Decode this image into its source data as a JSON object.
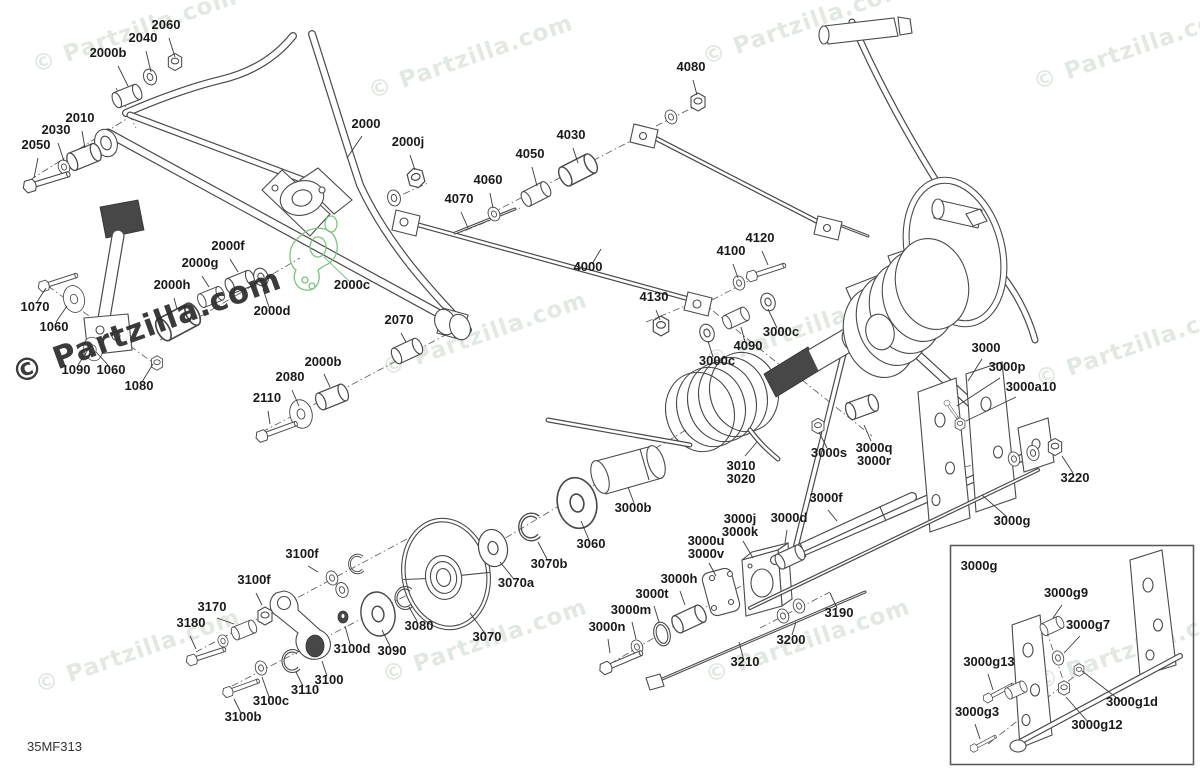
{
  "diagram": {
    "code": "35MF313",
    "watermark": {
      "text": "© Partzilla.com",
      "light_color": "#e2e8e2",
      "dark_color": "#2b2b2b"
    },
    "colors": {
      "line": "#4a4a4a",
      "label_text": "#1a1a1a",
      "highlight_green": "#7bc47f"
    },
    "watermarks": [
      {
        "x": 137,
        "y": 38,
        "rot": -19,
        "variant": "light"
      },
      {
        "x": 473,
        "y": 64,
        "rot": -19,
        "variant": "light"
      },
      {
        "x": 807,
        "y": 30,
        "rot": -19,
        "variant": "light"
      },
      {
        "x": 1138,
        "y": 55,
        "rot": -19,
        "variant": "light"
      },
      {
        "x": 150,
        "y": 336,
        "rot": -20,
        "variant": "dark"
      },
      {
        "x": 487,
        "y": 341,
        "rot": -19,
        "variant": "light"
      },
      {
        "x": 810,
        "y": 334,
        "rot": -19,
        "variant": "light"
      },
      {
        "x": 1140,
        "y": 352,
        "rot": -19,
        "variant": "light"
      },
      {
        "x": 140,
        "y": 658,
        "rot": -19,
        "variant": "light"
      },
      {
        "x": 487,
        "y": 648,
        "rot": -19,
        "variant": "light"
      },
      {
        "x": 810,
        "y": 648,
        "rot": -19,
        "variant": "light"
      },
      {
        "x": 1140,
        "y": 655,
        "rot": -19,
        "variant": "light"
      }
    ],
    "labels": [
      {
        "text": "2000b",
        "x": 108,
        "y": 57,
        "leader": [
          118,
          66,
          128,
          86
        ]
      },
      {
        "text": "2040",
        "x": 143,
        "y": 42,
        "leader": [
          146,
          51,
          151,
          72
        ]
      },
      {
        "text": "2060",
        "x": 166,
        "y": 29,
        "leader": [
          169,
          38,
          175,
          57
        ]
      },
      {
        "text": "2010",
        "x": 80,
        "y": 122,
        "leader": [
          82,
          131,
          85,
          148
        ]
      },
      {
        "text": "2030",
        "x": 56,
        "y": 134,
        "leader": [
          58,
          143,
          64,
          161
        ]
      },
      {
        "text": "2050",
        "x": 36,
        "y": 149,
        "leader": [
          38,
          158,
          34,
          178
        ]
      },
      {
        "text": "2000",
        "x": 366,
        "y": 128,
        "leader": [
          362,
          136,
          347,
          158
        ]
      },
      {
        "text": "2000j",
        "x": 408,
        "y": 146,
        "leader": [
          410,
          155,
          415,
          170
        ]
      },
      {
        "text": "4030",
        "x": 571,
        "y": 139,
        "leader": [
          573,
          148,
          578,
          163
        ]
      },
      {
        "text": "4050",
        "x": 530,
        "y": 158,
        "leader": [
          532,
          167,
          537,
          186
        ]
      },
      {
        "text": "4060",
        "x": 488,
        "y": 184,
        "leader": [
          490,
          193,
          493,
          208
        ]
      },
      {
        "text": "4070",
        "x": 459,
        "y": 203,
        "leader": [
          461,
          212,
          468,
          228
        ]
      },
      {
        "text": "4080",
        "x": 691,
        "y": 71,
        "leader": [
          693,
          80,
          697,
          95
        ]
      },
      {
        "text": "4000",
        "x": 588,
        "y": 271,
        "leader": [
          592,
          264,
          601,
          249
        ]
      },
      {
        "text": "4120",
        "x": 760,
        "y": 242,
        "leader": [
          762,
          251,
          768,
          265
        ]
      },
      {
        "text": "4100",
        "x": 731,
        "y": 255,
        "leader": [
          733,
          264,
          738,
          278
        ]
      },
      {
        "text": "4130",
        "x": 654,
        "y": 301,
        "leader": [
          656,
          310,
          660,
          320
        ]
      },
      {
        "text": "3000c",
        "x": 781,
        "y": 336,
        "leader": [
          777,
          328,
          768,
          309
        ]
      },
      {
        "text": "4090",
        "x": 748,
        "y": 350,
        "leader": [
          745,
          342,
          741,
          327
        ]
      },
      {
        "text": "3000c",
        "x": 717,
        "y": 365,
        "leader": [
          713,
          357,
          708,
          341
        ]
      },
      {
        "text": "2000f",
        "x": 228,
        "y": 250,
        "leader": [
          230,
          259,
          238,
          272
        ]
      },
      {
        "text": "2000g",
        "x": 200,
        "y": 267,
        "leader": [
          202,
          276,
          209,
          287
        ]
      },
      {
        "text": "2000h",
        "x": 172,
        "y": 289,
        "leader": [
          174,
          298,
          177,
          309
        ]
      },
      {
        "text": "2000c",
        "x": 352,
        "y": 289,
        "leader": [
          349,
          281,
          324,
          257
        ],
        "green": true
      },
      {
        "text": "2000d",
        "x": 272,
        "y": 315,
        "leader": [
          269,
          307,
          263,
          289
        ]
      },
      {
        "text": "2070",
        "x": 399,
        "y": 324,
        "leader": [
          401,
          333,
          406,
          342
        ]
      },
      {
        "text": "1070",
        "x": 35,
        "y": 311,
        "leader": [
          37,
          302,
          46,
          288
        ]
      },
      {
        "text": "1060",
        "x": 54,
        "y": 331,
        "leader": [
          56,
          322,
          67,
          306
        ]
      },
      {
        "text": "1090",
        "x": 76,
        "y": 374,
        "leader": [
          78,
          365,
          89,
          348
        ]
      },
      {
        "text": "1060",
        "x": 111,
        "y": 374,
        "leader": [
          108,
          365,
          96,
          352
        ]
      },
      {
        "text": "1080",
        "x": 139,
        "y": 390,
        "leader": [
          142,
          382,
          153,
          364
        ]
      },
      {
        "text": "2000b",
        "x": 323,
        "y": 366,
        "leader": [
          324,
          374,
          330,
          387
        ]
      },
      {
        "text": "2080",
        "x": 290,
        "y": 381,
        "leader": [
          292,
          390,
          299,
          406
        ]
      },
      {
        "text": "2110",
        "x": 267,
        "y": 402,
        "leader": [
          268,
          411,
          270,
          424
        ]
      },
      {
        "text": "3010\n3020",
        "x": 741,
        "y": 470,
        "leader": [
          745,
          456,
          757,
          442
        ]
      },
      {
        "text": "3000b",
        "x": 633,
        "y": 512,
        "leader": [
          634,
          503,
          628,
          487
        ]
      },
      {
        "text": "3000s",
        "x": 829,
        "y": 457,
        "leader": [
          827,
          448,
          819,
          432
        ]
      },
      {
        "text": "3000q\n3000r",
        "x": 874,
        "y": 452,
        "leader": [
          871,
          441,
          864,
          425
        ]
      },
      {
        "text": "3000",
        "x": 986,
        "y": 352,
        "leader": [
          982,
          359,
          968,
          381
        ]
      },
      {
        "text": "3000p",
        "x": 1007,
        "y": 371,
        "leader": [
          1000,
          378,
          957,
          406
        ]
      },
      {
        "text": "3000a10",
        "x": 1031,
        "y": 391,
        "leader": [
          1016,
          397,
          966,
          421
        ]
      },
      {
        "text": "3220",
        "x": 1075,
        "y": 482,
        "leader": [
          1073,
          473,
          1062,
          456
        ]
      },
      {
        "text": "3000f",
        "x": 826,
        "y": 502,
        "leader": [
          828,
          510,
          837,
          521
        ]
      },
      {
        "text": "3000g",
        "x": 1012,
        "y": 525,
        "leader": [
          1007,
          517,
          982,
          495
        ]
      },
      {
        "text": "3000j\n3000k",
        "x": 740,
        "y": 523,
        "leader": [
          743,
          541,
          753,
          558
        ]
      },
      {
        "text": "3000u\n3000v",
        "x": 706,
        "y": 545,
        "leader": [
          709,
          563,
          716,
          576
        ]
      },
      {
        "text": "3000d",
        "x": 789,
        "y": 522,
        "leader": [
          787,
          530,
          785,
          543
        ]
      },
      {
        "text": "3060",
        "x": 591,
        "y": 548,
        "leader": [
          589,
          540,
          581,
          521
        ]
      },
      {
        "text": "3070b",
        "x": 549,
        "y": 568,
        "leader": [
          547,
          559,
          538,
          542
        ]
      },
      {
        "text": "3070a",
        "x": 516,
        "y": 587,
        "leader": [
          513,
          578,
          500,
          562
        ]
      },
      {
        "text": "3100f",
        "x": 302,
        "y": 558,
        "leader": [
          308,
          566,
          318,
          572
        ]
      },
      {
        "text": "3100f",
        "x": 254,
        "y": 584,
        "leader": [
          256,
          593,
          262,
          605
        ]
      },
      {
        "text": "3170",
        "x": 212,
        "y": 611,
        "leader": [
          217,
          618,
          234,
          624
        ]
      },
      {
        "text": "3180",
        "x": 191,
        "y": 627,
        "leader": [
          190,
          636,
          196,
          649
        ]
      },
      {
        "text": "3080",
        "x": 419,
        "y": 630,
        "leader": [
          417,
          621,
          409,
          607
        ]
      },
      {
        "text": "3090",
        "x": 392,
        "y": 655,
        "leader": [
          390,
          646,
          382,
          630
        ]
      },
      {
        "text": "3100d",
        "x": 352,
        "y": 653,
        "leader": [
          350,
          644,
          345,
          626
        ]
      },
      {
        "text": "3070",
        "x": 487,
        "y": 641,
        "leader": [
          484,
          632,
          470,
          613
        ]
      },
      {
        "text": "3000h",
        "x": 679,
        "y": 583,
        "leader": [
          680,
          591,
          685,
          605
        ]
      },
      {
        "text": "3000t",
        "x": 652,
        "y": 598,
        "leader": [
          654,
          606,
          659,
          622
        ]
      },
      {
        "text": "3000m",
        "x": 631,
        "y": 614,
        "leader": [
          632,
          622,
          636,
          639
        ]
      },
      {
        "text": "3000n",
        "x": 607,
        "y": 631,
        "leader": [
          608,
          639,
          610,
          653
        ]
      },
      {
        "text": "3200",
        "x": 791,
        "y": 644,
        "leader": [
          792,
          635,
          796,
          622
        ]
      },
      {
        "text": "3210",
        "x": 745,
        "y": 666,
        "leader": [
          743,
          657,
          739,
          642
        ]
      },
      {
        "text": "3190",
        "x": 839,
        "y": 617,
        "leader": [
          837,
          608,
          830,
          593
        ]
      },
      {
        "text": "3100",
        "x": 329,
        "y": 684,
        "leader": [
          327,
          676,
          322,
          661
        ]
      },
      {
        "text": "3110",
        "x": 305,
        "y": 694,
        "leader": [
          303,
          686,
          296,
          672
        ]
      },
      {
        "text": "3100c",
        "x": 271,
        "y": 705,
        "leader": [
          269,
          697,
          262,
          677
        ]
      },
      {
        "text": "3100b",
        "x": 243,
        "y": 721,
        "leader": [
          241,
          713,
          234,
          699
        ]
      },
      {
        "text": "3000g",
        "x": 979,
        "y": 570
      },
      {
        "text": "3000g9",
        "x": 1066,
        "y": 597,
        "leader": [
          1062,
          605,
          1053,
          618
        ]
      },
      {
        "text": "3000g7",
        "x": 1088,
        "y": 629,
        "leader": [
          1080,
          636,
          1064,
          653
        ]
      },
      {
        "text": "3000g13",
        "x": 989,
        "y": 666,
        "leader": [
          988,
          674,
          993,
          690
        ]
      },
      {
        "text": "3000g1d",
        "x": 1132,
        "y": 706,
        "leader": [
          1122,
          702,
          1082,
          671
        ]
      },
      {
        "text": "3000g12",
        "x": 1097,
        "y": 729,
        "leader": [
          1088,
          722,
          1066,
          697
        ]
      },
      {
        "text": "3000g3",
        "x": 977,
        "y": 716,
        "leader": [
          975,
          724,
          980,
          739
        ]
      }
    ]
  }
}
